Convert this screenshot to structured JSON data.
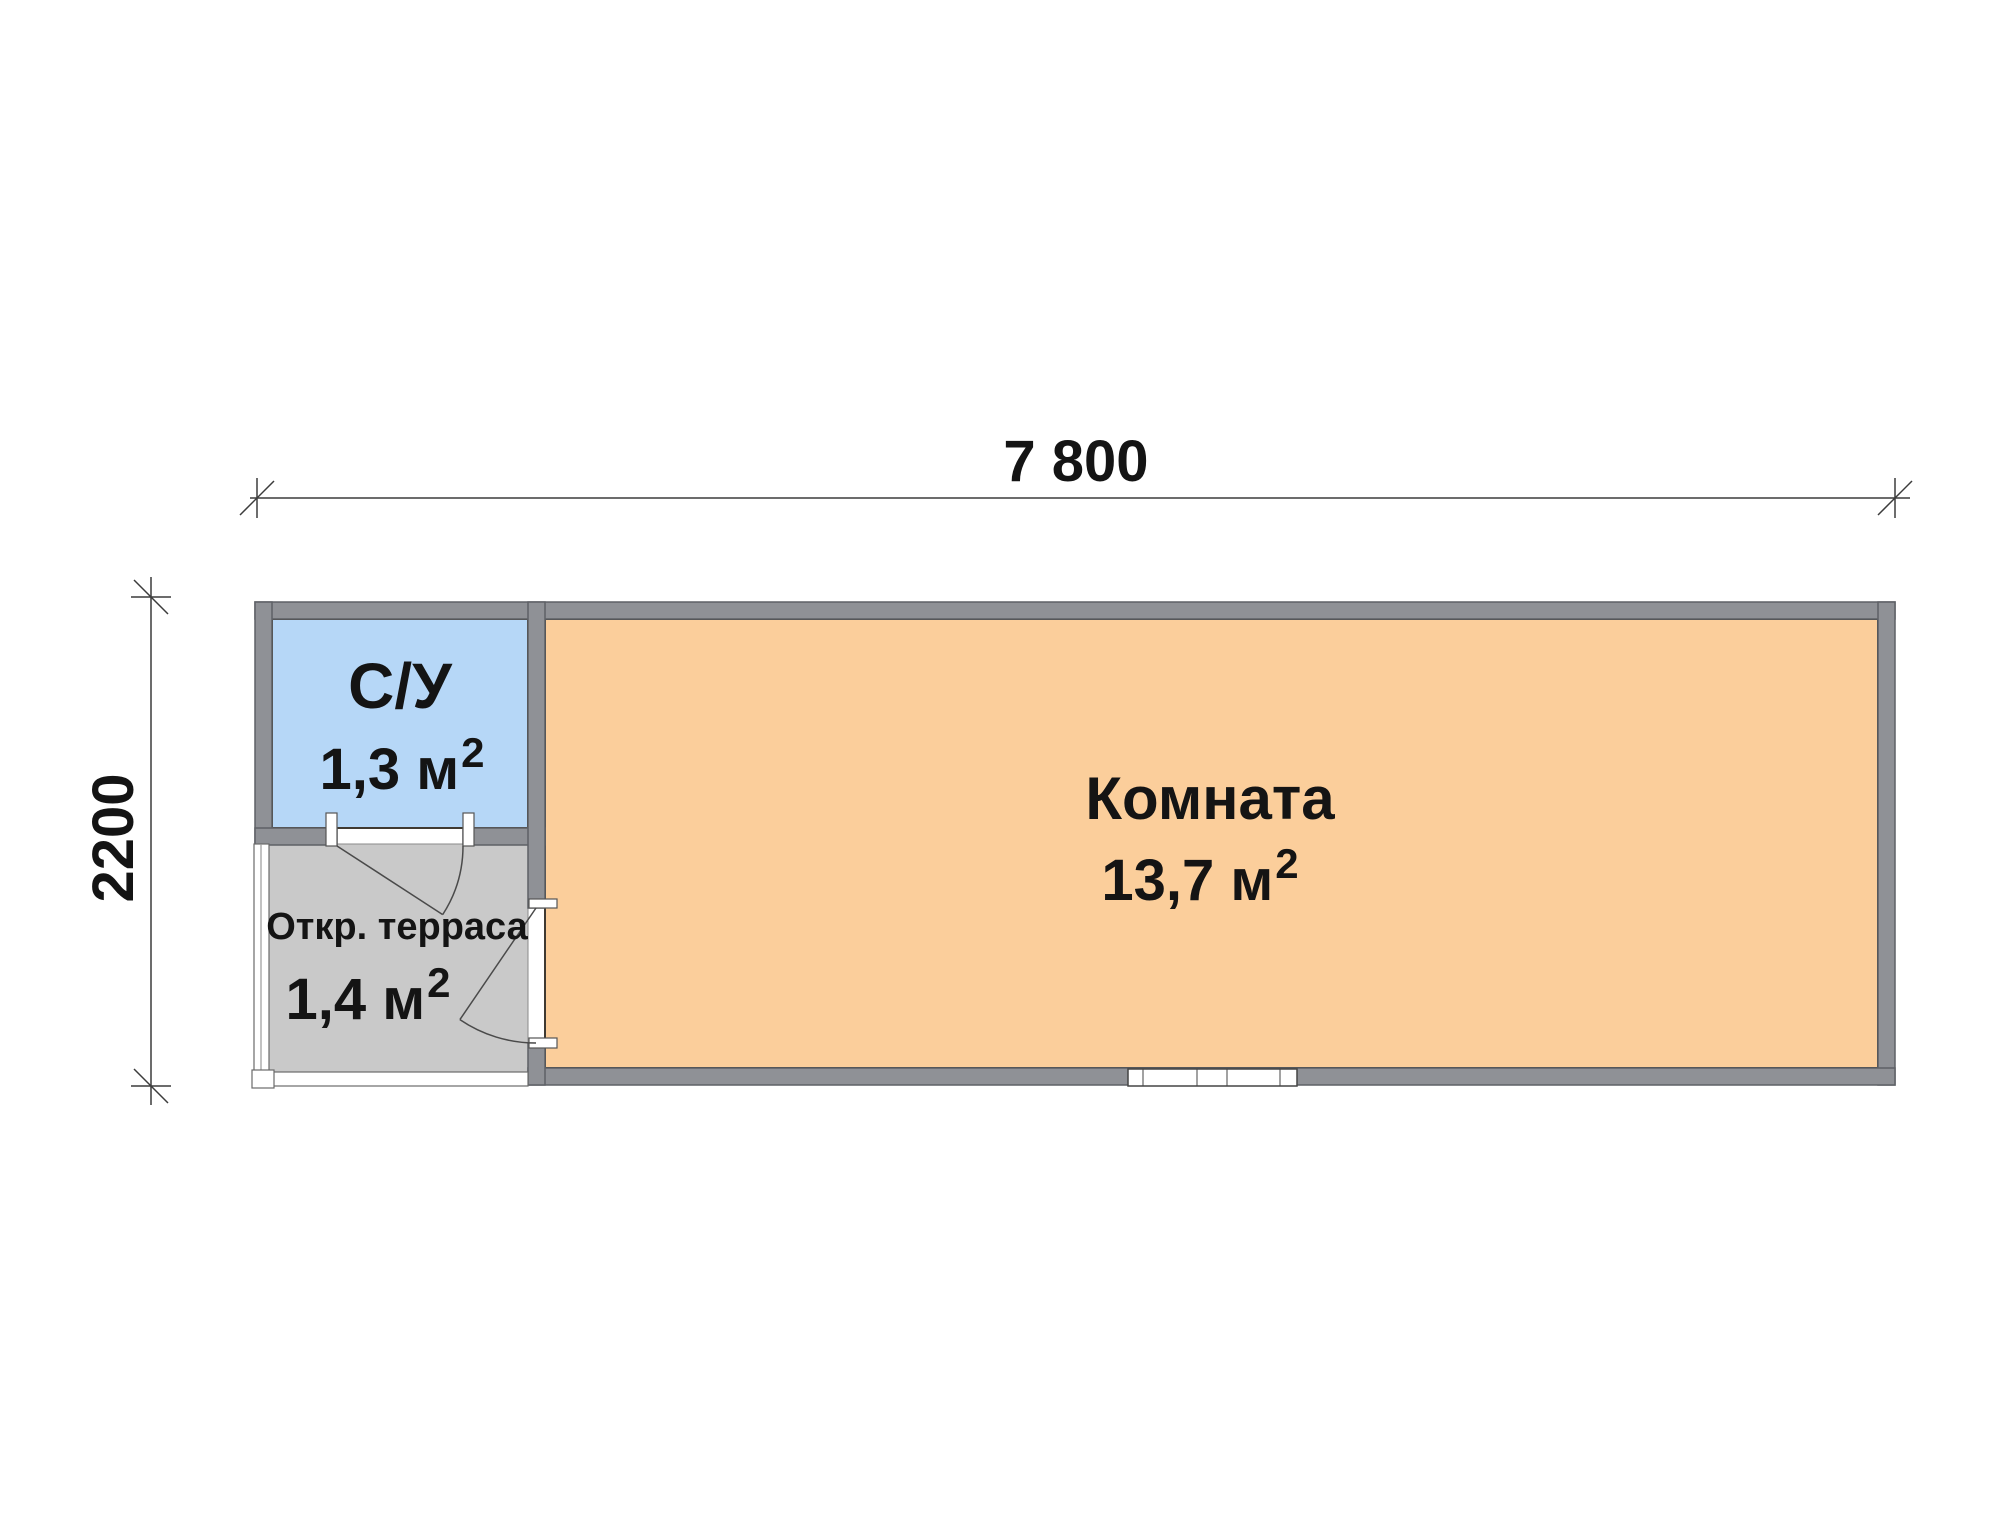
{
  "plan": {
    "title": "cabin-floor-plan",
    "dimensions": {
      "width_label": "7 800",
      "height_label": "2200"
    },
    "rooms": [
      {
        "id": "bathroom",
        "name": "С/У",
        "area_value": "1,3 м",
        "area_sup": "2",
        "fill": "#b6d7f7"
      },
      {
        "id": "room",
        "name": "Комната",
        "area_value": "13,7 м",
        "area_sup": "2",
        "fill": "#fbce9b"
      },
      {
        "id": "terrace",
        "name": "Откр. терраса",
        "area_value": "1,4 м",
        "area_sup": "2",
        "fill": "#c9c9c9"
      }
    ],
    "colors": {
      "wall": "#8f9196",
      "wall_edge": "#5e6166",
      "room_outline": "#3f3a32",
      "dim_line": "#3c3c3c",
      "opening": "#ffffff"
    }
  }
}
